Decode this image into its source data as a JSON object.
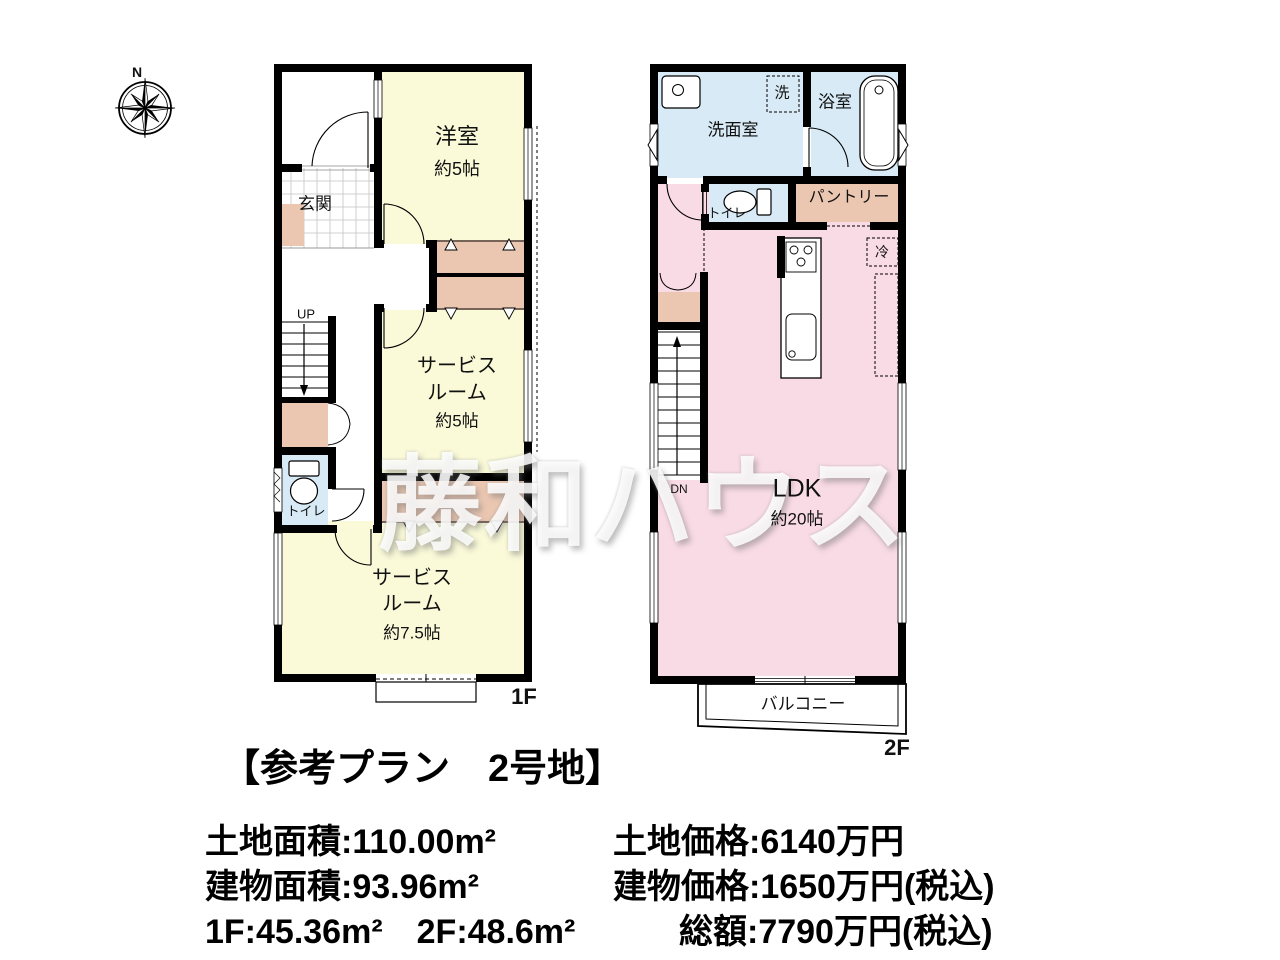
{
  "compass": {
    "north_label": "N"
  },
  "watermark_text": "藤和ハウス",
  "plan_title": "【参考プラン　2号地】",
  "floor1": {
    "floor_label": "1F",
    "entrance": "玄関",
    "western_room": "洋室",
    "western_room_size": "約5帖",
    "stairs_label": "UP",
    "toilet": "トイレ",
    "service_room_5": {
      "line1": "サービス",
      "line2": "ルーム",
      "size": "約5帖"
    },
    "service_room_75": {
      "line1": "サービス",
      "line2": "ルーム",
      "size": "約7.5帖"
    }
  },
  "floor2": {
    "floor_label": "2F",
    "washroom": "洗面室",
    "washer": "洗",
    "bathroom": "浴室",
    "toilet": "トイレ",
    "pantry": "パントリー",
    "refrigerator": "冷",
    "ldk": "LDK",
    "ldk_size": "約20帖",
    "stairs_label": "DN",
    "balcony": "バルコニー"
  },
  "details": {
    "land_area": "土地面積:110.00m²",
    "building_area": "建物面積:93.96m²",
    "floor_areas": "1F:45.36m²　2F:48.6m²",
    "land_price": "土地価格:6140万円",
    "building_price": "建物価格:1650万円(税込)",
    "total_price": "総額:7790万円(税込)"
  },
  "colors": {
    "room_cream": "#FAFAD9",
    "room_pink": "#F9DBE5",
    "room_blue": "#D7EAF6",
    "closet_tan": "#EBC7B2",
    "wall": "#000000"
  }
}
